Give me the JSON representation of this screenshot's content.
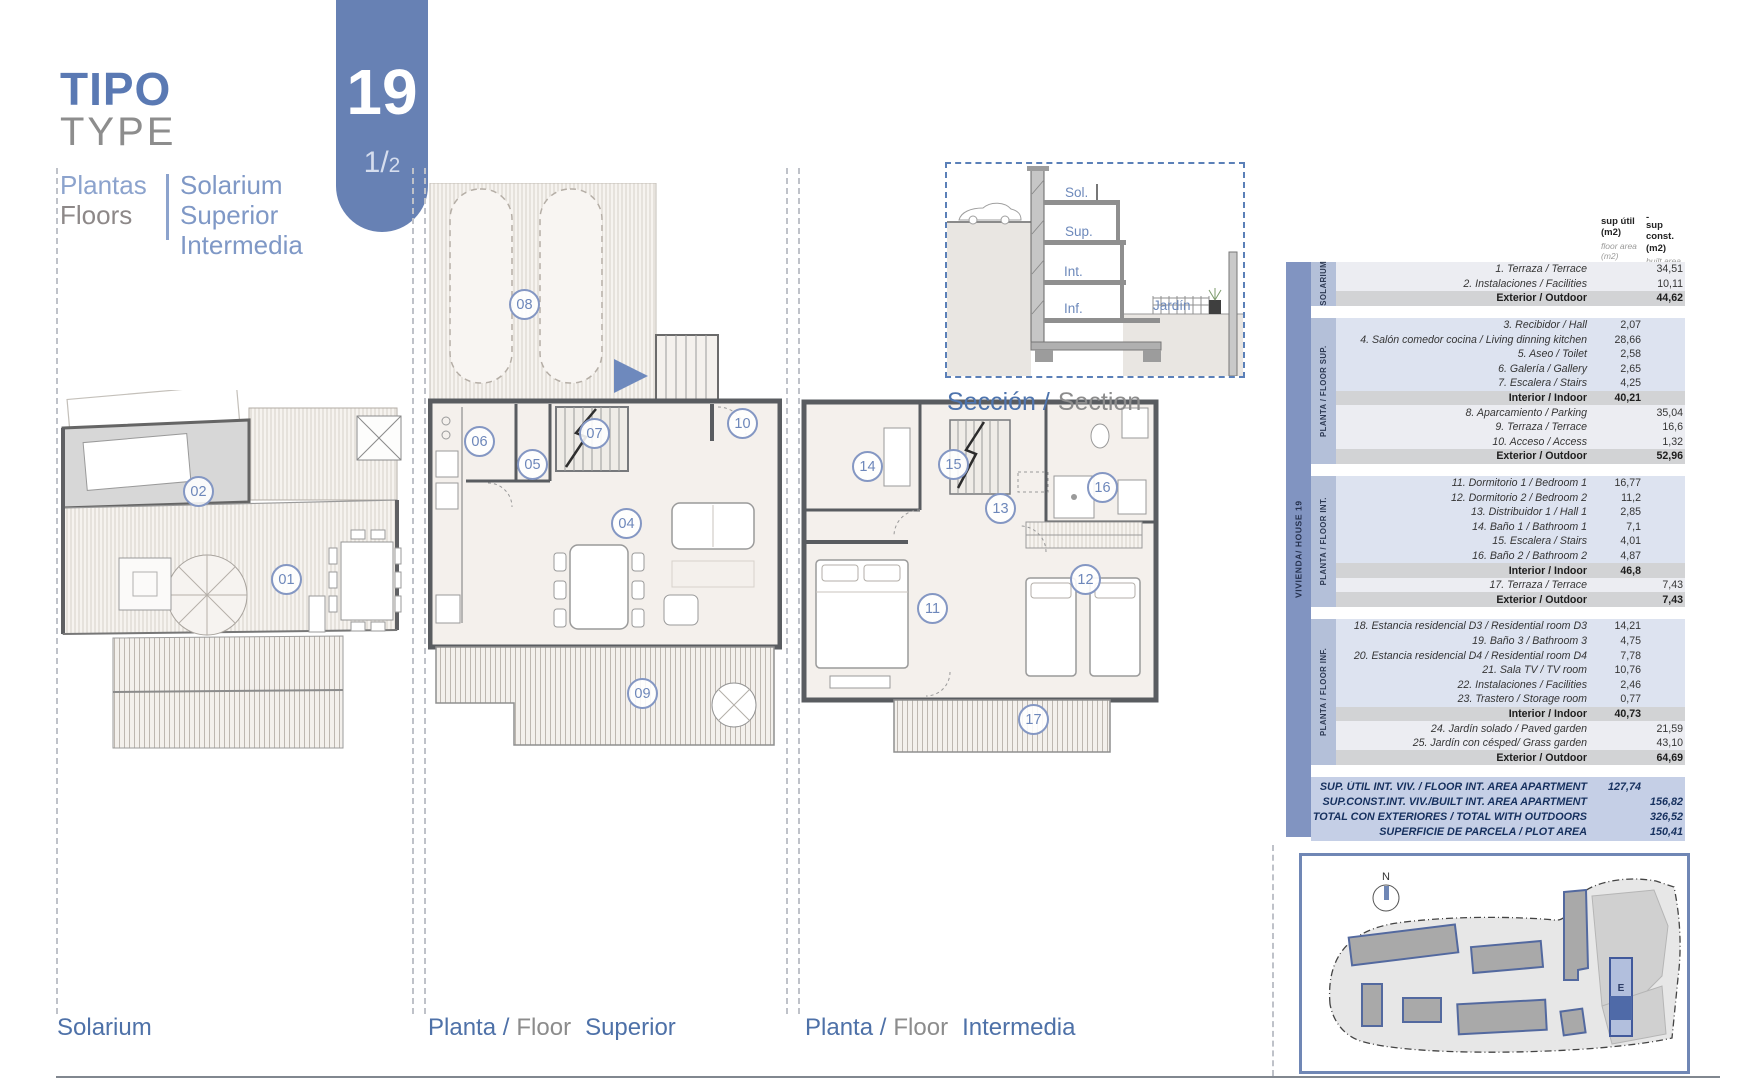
{
  "header": {
    "title_primary": "TIPO",
    "title_secondary": "TYPE",
    "type_badge": {
      "number": "19",
      "fraction_main": "1/",
      "fraction_sub": "2"
    },
    "floors_label_es": "Plantas",
    "floors_label_en": "Floors",
    "floors_list": "Solarium\nSuperior\nIntermedia"
  },
  "captions": {
    "solarium": "Solarium",
    "superior": {
      "p1": "Planta /",
      "p2": "Floor",
      "p3": "Superior"
    },
    "intermedia": {
      "p1": "Planta /",
      "p2": "Floor",
      "p3": "Intermedia"
    },
    "section": {
      "p1": "Sección /",
      "p2": "Section"
    }
  },
  "plans": {
    "solarium": {
      "rooms": [
        "01",
        "02"
      ]
    },
    "superior": {
      "rooms": [
        "04",
        "05",
        "06",
        "07",
        "08",
        "09",
        "10"
      ]
    },
    "intermedia": {
      "rooms": [
        "11",
        "12",
        "13",
        "14",
        "15",
        "16",
        "17"
      ]
    }
  },
  "section": {
    "labels": [
      "Sol.",
      "Sup.",
      "Int.",
      "Inf.",
      "Jardín"
    ]
  },
  "site_plan": {
    "north_label": "N",
    "building_label": "E"
  },
  "table": {
    "side_label": "VIVIENDA/ HOUSE 19",
    "columns": {
      "util": {
        "title": "sup útil\n(m2)",
        "sub": "floor area\n(m2)"
      },
      "const": {
        "overline": "-",
        "title": "sup const.\n(m2)",
        "sub": "built area\n(m2)"
      }
    },
    "groups": [
      {
        "band": "SOLARIUM",
        "rows": [
          {
            "label": "1. Terraza / Terrace",
            "util": "",
            "const": "34,51"
          },
          {
            "label": "2. Instalaciones / Facilities",
            "util": "",
            "const": "10,11"
          },
          {
            "label": "Exterior / Outdoor",
            "util": "",
            "const": "44,62",
            "total": true
          }
        ]
      },
      {
        "band": "PLANTA / FLOOR  SUP.",
        "rows": [
          {
            "label": "3. Recibidor / Hall",
            "util": "2,07",
            "const": ""
          },
          {
            "label": "4. Salón comedor cocina / Living dinning kitchen",
            "util": "28,66",
            "const": ""
          },
          {
            "label": "5. Aseo / Toilet",
            "util": "2,58",
            "const": ""
          },
          {
            "label": "6. Galería / Gallery",
            "util": "2,65",
            "const": ""
          },
          {
            "label": "7. Escalera / Stairs",
            "util": "4,25",
            "const": ""
          },
          {
            "label": "Interior / Indoor",
            "util": "40,21",
            "const": "",
            "total": true
          },
          {
            "label": "8. Aparcamiento / Parking",
            "util": "",
            "const": "35,04"
          },
          {
            "label": "9. Terraza / Terrace",
            "util": "",
            "const": "16,6"
          },
          {
            "label": "10. Acceso / Access",
            "util": "",
            "const": "1,32"
          },
          {
            "label": "Exterior / Outdoor",
            "util": "",
            "const": "52,96",
            "total": true
          }
        ]
      },
      {
        "band": "PLANTA / FLOOR  INT.",
        "rows": [
          {
            "label": "11. Dormitorio 1 / Bedroom 1",
            "util": "16,77",
            "const": ""
          },
          {
            "label": "12. Dormitorio 2 / Bedroom 2",
            "util": "11,2",
            "const": ""
          },
          {
            "label": "13. Distribuidor 1 / Hall 1",
            "util": "2,85",
            "const": ""
          },
          {
            "label": "14. Baño 1 / Bathroom 1",
            "util": "7,1",
            "const": ""
          },
          {
            "label": "15. Escalera / Stairs",
            "util": "4,01",
            "const": ""
          },
          {
            "label": "16. Baño 2 / Bathroom 2",
            "util": "4,87",
            "const": ""
          },
          {
            "label": "Interior / Indoor",
            "util": "46,8",
            "const": "",
            "total": true
          },
          {
            "label": "17. Terraza / Terrace",
            "util": "",
            "const": "7,43"
          },
          {
            "label": "Exterior / Outdoor",
            "util": "",
            "const": "7,43",
            "total": true
          }
        ]
      },
      {
        "band": "PLANTA / FLOOR  INF.",
        "rows": [
          {
            "label": "18. Estancia residencial D3 / Residential room D3",
            "util": "14,21",
            "const": ""
          },
          {
            "label": "19. Baño 3 / Bathroom 3",
            "util": "4,75",
            "const": ""
          },
          {
            "label": "20. Estancia residencial D4 / Residential room D4",
            "util": "7,78",
            "const": ""
          },
          {
            "label": "21. Sala TV / TV room",
            "util": "10,76",
            "const": ""
          },
          {
            "label": "22. Instalaciones / Facilities",
            "util": "2,46",
            "const": ""
          },
          {
            "label": "23. Trastero / Storage room",
            "util": "0,77",
            "const": ""
          },
          {
            "label": "Interior / Indoor",
            "util": "40,73",
            "const": "",
            "total": true
          },
          {
            "label": "24. Jardín solado / Paved garden",
            "util": "",
            "const": "21,59"
          },
          {
            "label": "25. Jardín con césped/ Grass garden",
            "util": "",
            "const": "43,10"
          },
          {
            "label": "Exterior / Outdoor",
            "util": "",
            "const": "64,69",
            "total": true
          }
        ]
      }
    ],
    "summary": [
      {
        "label": "SUP. ÚTIL INT. VIV. / FLOOR INT. AREA APARTMENT",
        "util": "127,74",
        "const": ""
      },
      {
        "label": "SUP.CONST.INT. VIV./BUILT INT. AREA APARTMENT",
        "util": "",
        "const": "156,82"
      },
      {
        "label": "TOTAL CON EXTERIORES / TOTAL WITH OUTDOORS",
        "util": "",
        "const": "326,52"
      },
      {
        "label": "SUPERFICIE DE PARCELA / PLOT AREA",
        "util": "",
        "const": "150,41"
      }
    ]
  },
  "colors": {
    "accent_blue": "#6781b4",
    "title_blue": "#5a79b3",
    "caption_blue": "#4e71a8",
    "table_band": "#8194c1",
    "table_subband": "#b4c0d9",
    "row_blue": "#dde3f0",
    "row_light": "#ecedf2",
    "row_total": "#d2d3d5",
    "summary_bg": "#c5cfe6",
    "wall_gray": "#595c60"
  }
}
